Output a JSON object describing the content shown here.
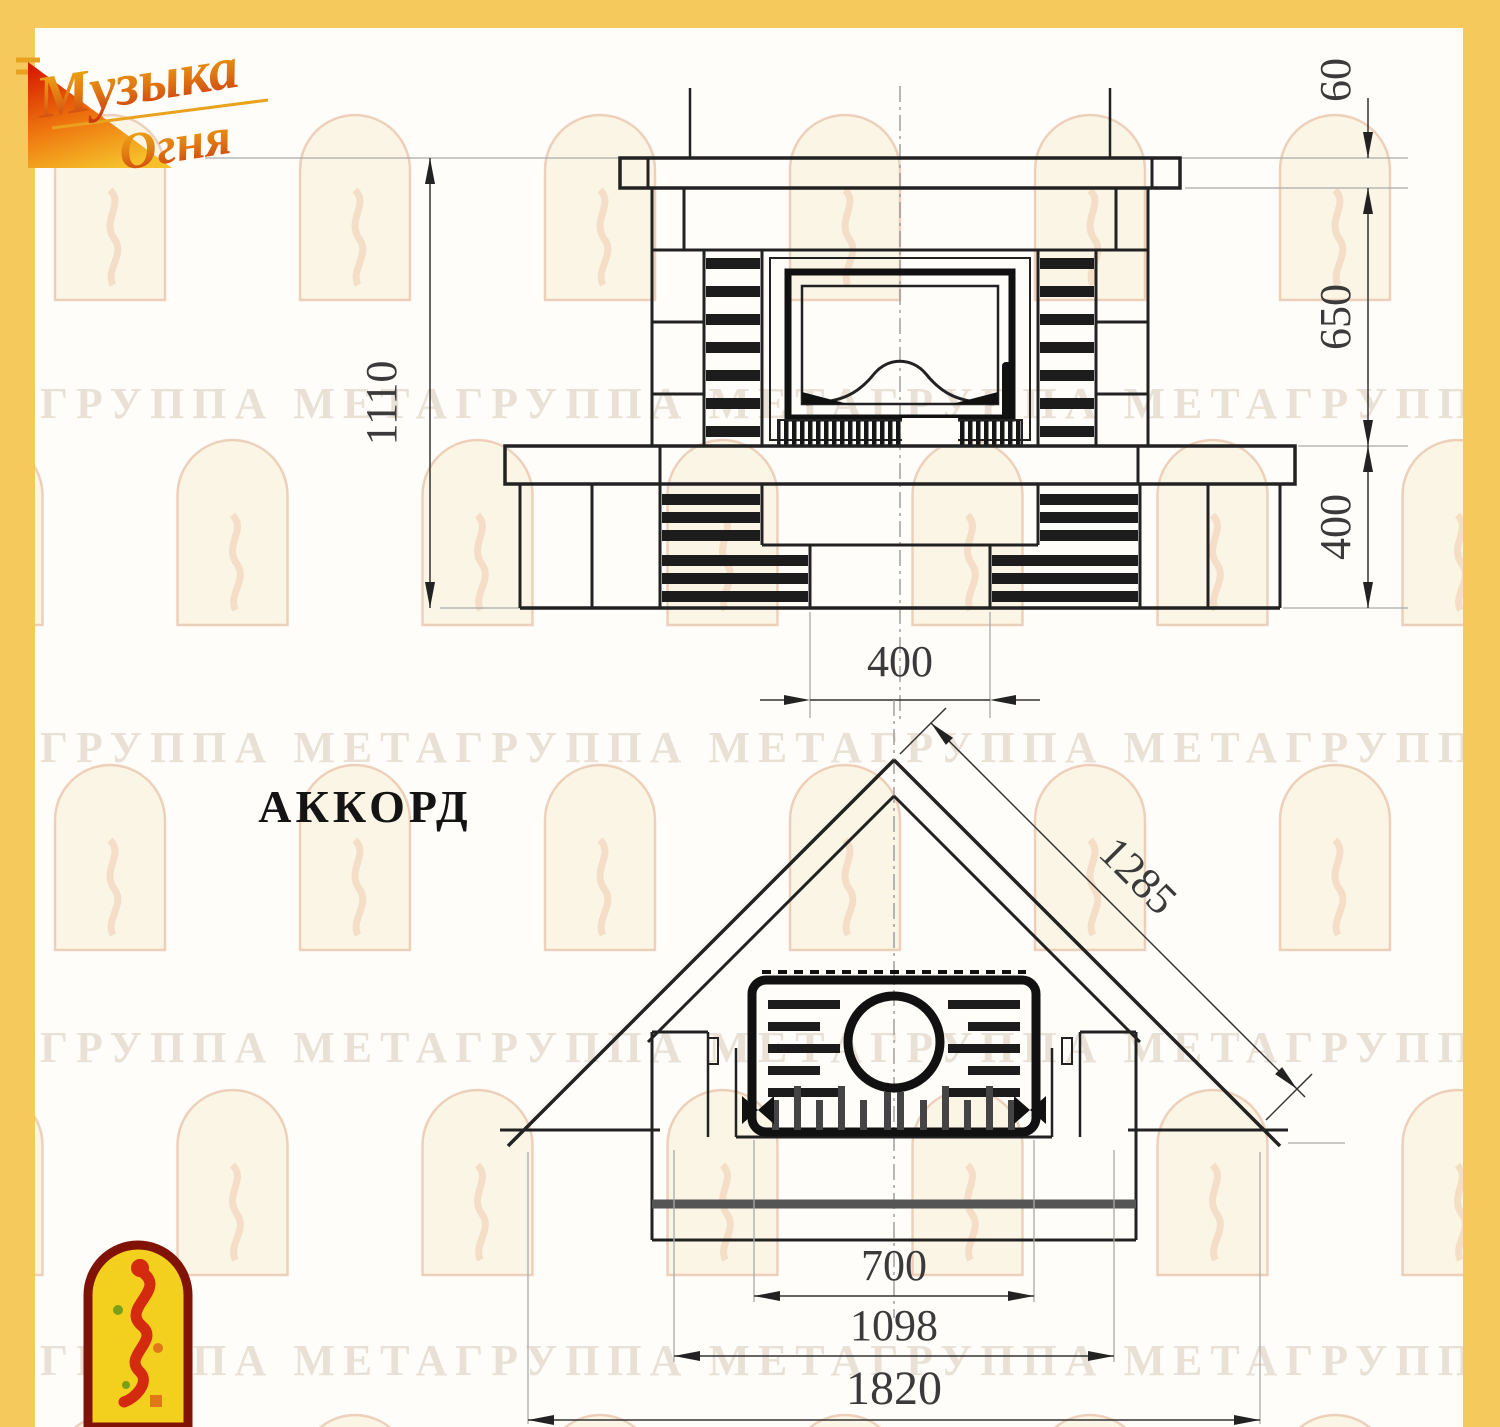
{
  "logo": {
    "line1": "Музыка",
    "line2": "Огня"
  },
  "title": "АККОРД",
  "watermark": {
    "text": "ГРУППА МЕТАГРУППА МЕТАГРУППА МЕТАГРУППА МЕТА"
  },
  "front_view": {
    "dims": {
      "total_height": "1110",
      "shelf_thickness": "60",
      "opening_height": "650",
      "base_height": "400",
      "niche_width": "400"
    }
  },
  "plan_view": {
    "dims": {
      "diagonal_width": "1285",
      "firebox_width": "700",
      "inner_width": "1098",
      "overall_width": "1820"
    }
  },
  "colors": {
    "frame_yellow": "#f5c95c",
    "drawing_line": "#222222",
    "accent_red": "#d42b10",
    "logo_gold": "#e8a21e"
  }
}
